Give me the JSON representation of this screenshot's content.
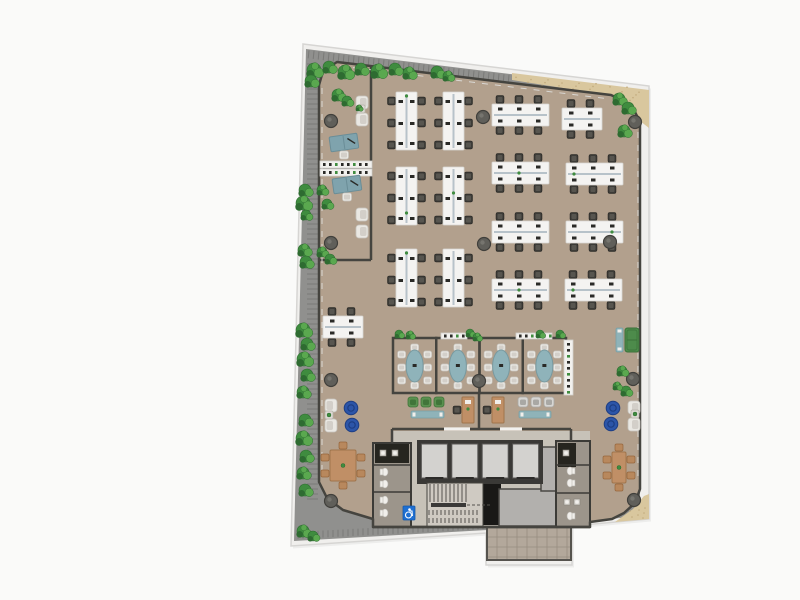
{
  "canvas": {
    "w": 800,
    "h": 600,
    "bg": "#fafaf9"
  },
  "palette": {
    "slab_fill": "#f0efed",
    "slab_stroke": "#d6d5d3",
    "shadow": "rgba(0,0,0,0.05)",
    "walkway": "#90908e",
    "walkway_line": "#7a7a78",
    "sand": "#d9c79e",
    "sand_dot": "#c2ab7d",
    "floor": "#b2a08d",
    "wall": "#45443f",
    "rail": "#d9d7d3",
    "desk_white": "#f4f3f1",
    "desk_stroke": "#d8d7d4",
    "spine": "#b7c2c9",
    "chair_dark": "#3c3b37",
    "chair_dark_hi": "#57554f",
    "item_dark": "#2a2a27",
    "teal_desk": "#7fa3ad",
    "teal_desk_dk": "#6a8d97",
    "meet_table": "#8fb3ba",
    "meet_table_dk": "#78999f",
    "chair_white": "#eae8e3",
    "chair_white_dk": "#c7c4be",
    "chair_white_in": "#d3cfc9",
    "green_dark": "#2e6b31",
    "green_mid": "#3f8c3f",
    "green_light": "#5aa84f",
    "pouf_blue": "#2c55a8",
    "pouf_blue_dk": "#1d3d82",
    "wood": "#c08f66",
    "wood_dk": "#a0754c",
    "wood_chair": "#b8885d",
    "sofa_green": "#4d8b4b",
    "sofa_green_dk": "#3a7139",
    "bench_teal": "#8fb3b9",
    "bench_teal_dk": "#79a0a7",
    "green_chair": "#5a9150",
    "green_chair_dk": "#41753a",
    "gray_chair": "#d7d6d3",
    "gray_chair_dk": "#a9a8a4",
    "column_fill": "#605f5a",
    "column_stroke": "#403f3b",
    "core_floor": "#c7c2b8",
    "elev_bank": "#3a3936",
    "elev_car": "#d3d2cf",
    "elev_car_stroke": "#595855",
    "dark_room": "#191816",
    "gray_room": "#b2b0ad",
    "wc_floor": "#9c958b",
    "wc_dark": "#26251f",
    "fixture": "#f1efeb",
    "stair_floor": "#cfcac2",
    "stair_line": "#55534d",
    "sign_blue": "#1e6fd2",
    "terrace": "#b3a89b",
    "terrace_line": "#978d80",
    "credenza": "#f2f1ee",
    "credenza_stroke": "#d2d1cd"
  },
  "plan": {
    "slab": [
      [
        303,
        44
      ],
      [
        649,
        86
      ],
      [
        649,
        519
      ],
      [
        572,
        526
      ],
      [
        572,
        565
      ],
      [
        486,
        565
      ],
      [
        486,
        533
      ],
      [
        291,
        546
      ]
    ],
    "walkway": [
      [
        306,
        49
      ],
      [
        640,
        90
      ],
      [
        640,
        516
      ],
      [
        571,
        523
      ],
      [
        571,
        561
      ],
      [
        487,
        561
      ],
      [
        487,
        530
      ],
      [
        294,
        541
      ]
    ],
    "sand_top": [
      [
        512,
        73
      ],
      [
        649,
        90
      ],
      [
        649,
        128
      ],
      [
        640,
        121
      ],
      [
        614,
        96
      ],
      [
        512,
        80
      ]
    ],
    "sand_br": [
      [
        649,
        494
      ],
      [
        649,
        519
      ],
      [
        615,
        522
      ],
      [
        633,
        509
      ],
      [
        644,
        496
      ]
    ],
    "floor": [
      [
        337,
        62
      ],
      [
        611,
        95
      ],
      [
        624,
        101
      ],
      [
        634,
        110
      ],
      [
        640,
        122
      ],
      [
        640,
        489
      ],
      [
        635,
        503
      ],
      [
        624,
        513
      ],
      [
        612,
        519
      ],
      [
        590,
        522
      ],
      [
        590,
        527
      ],
      [
        373,
        527
      ],
      [
        373,
        519
      ],
      [
        343,
        510
      ],
      [
        327,
        498
      ],
      [
        319,
        482
      ],
      [
        319,
        85
      ],
      [
        323,
        71
      ]
    ],
    "terrace": {
      "x": 487,
      "y": 527,
      "w": 84,
      "h": 33
    },
    "inner_walls": "M371,66 L371,260 M319,260 L371,260 M319,168 L371,168 M479,393 L479,429 M392,429 L571,429 M392,429 L392,443 M571,429 L571,441 M373,527 L590,527",
    "rails": [
      [
        340,
        66,
        610,
        99
      ],
      [
        322,
        88,
        322,
        474
      ],
      [
        638,
        132,
        638,
        482
      ]
    ],
    "door_gaps": [
      [
        444,
        429,
        26
      ],
      [
        500,
        429,
        22
      ]
    ],
    "core": {
      "floor": [
        392,
        431,
        198,
        96
      ],
      "wc_left": {
        "x": 373,
        "y": 443,
        "w": 38,
        "h": 84
      },
      "wc_right": {
        "x": 556,
        "y": 441,
        "w": 34,
        "h": 86
      },
      "elev": {
        "x": 417,
        "y": 440,
        "w": 126,
        "h": 44,
        "n": 4
      },
      "stairs": {
        "x": 427,
        "y": 483,
        "w": 56,
        "h": 44
      },
      "dark_room": [
        477,
        484,
        24,
        41
      ],
      "gray_rooms": [
        [
          499,
          489,
          61,
          37
        ],
        [
          541,
          447,
          19,
          44
        ]
      ],
      "sign": [
        403,
        506,
        12,
        14
      ]
    },
    "benches": [
      {
        "x": 396,
        "y": 92,
        "dir": "v",
        "seats": 6
      },
      {
        "x": 443,
        "y": 92,
        "dir": "v",
        "seats": 6
      },
      {
        "x": 396,
        "y": 167,
        "dir": "v",
        "seats": 6
      },
      {
        "x": 443,
        "y": 167,
        "dir": "v",
        "seats": 6
      },
      {
        "x": 396,
        "y": 249,
        "dir": "v",
        "seats": 6
      },
      {
        "x": 443,
        "y": 249,
        "dir": "v",
        "seats": 6
      },
      {
        "x": 492,
        "y": 104,
        "dir": "h",
        "seats": 6
      },
      {
        "x": 562,
        "y": 108,
        "dir": "h",
        "seats": 4
      },
      {
        "x": 492,
        "y": 162,
        "dir": "h",
        "seats": 6
      },
      {
        "x": 566,
        "y": 163,
        "dir": "h",
        "seats": 6
      },
      {
        "x": 492,
        "y": 221,
        "dir": "h",
        "seats": 6
      },
      {
        "x": 566,
        "y": 221,
        "dir": "h",
        "seats": 6
      },
      {
        "x": 492,
        "y": 279,
        "dir": "h",
        "seats": 6
      },
      {
        "x": 565,
        "y": 279,
        "dir": "h",
        "seats": 6
      },
      {
        "x": 323,
        "y": 316,
        "dir": "h",
        "seats": 4
      }
    ],
    "meeting": {
      "x": 393,
      "y": 338,
      "w": 173,
      "h": 55,
      "rooms": 4
    },
    "credenzas": [
      [
        320,
        161,
        52,
        7
      ],
      [
        320,
        169,
        52,
        7
      ],
      [
        441,
        333,
        26,
        6
      ],
      [
        516,
        333,
        36,
        6
      ],
      [
        564,
        340,
        9,
        55
      ]
    ],
    "exec_desks": [
      [
        330,
        135,
        -8
      ],
      [
        333,
        177,
        -8
      ]
    ],
    "armchairs": [
      [
        356,
        96,
        "L"
      ],
      [
        356,
        113,
        "L"
      ],
      [
        356,
        208,
        "L"
      ],
      [
        356,
        225,
        "L"
      ],
      [
        325,
        399,
        "R"
      ],
      [
        325,
        419,
        "R"
      ],
      [
        628,
        401,
        "L"
      ],
      [
        628,
        418,
        "L"
      ]
    ],
    "side_tables": [
      [
        357,
        105
      ],
      [
        325,
        411
      ],
      [
        631,
        410
      ]
    ],
    "poufs": [
      [
        351,
        408
      ],
      [
        352,
        425
      ],
      [
        613,
        408
      ],
      [
        611,
        424
      ]
    ],
    "dinings": [
      [
        330,
        450,
        26,
        31
      ],
      [
        612,
        452,
        14,
        31
      ]
    ],
    "hotdesks": [
      [
        462,
        397
      ],
      [
        492,
        397
      ]
    ],
    "trios": [
      {
        "x": 408,
        "y": 397,
        "c": "green"
      },
      {
        "x": 518,
        "y": 397,
        "c": "gray"
      }
    ],
    "teal_benches": [
      [
        411,
        411,
        33,
        7
      ],
      [
        519,
        411,
        32,
        7
      ],
      [
        616,
        328,
        7,
        24
      ]
    ],
    "sofa": [
      625,
      328,
      14,
      24
    ],
    "columns": [
      [
        331,
        121
      ],
      [
        331,
        243
      ],
      [
        331,
        380
      ],
      [
        331,
        501
      ],
      [
        483,
        117
      ],
      [
        484,
        244
      ],
      [
        479,
        381
      ],
      [
        610,
        242
      ],
      [
        635,
        122
      ],
      [
        633,
        379
      ],
      [
        634,
        500
      ]
    ],
    "plants": [
      [
        314,
        70,
        7
      ],
      [
        329,
        67,
        6
      ],
      [
        345,
        72,
        7
      ],
      [
        361,
        69,
        6
      ],
      [
        378,
        71,
        7
      ],
      [
        395,
        69,
        6
      ],
      [
        409,
        73,
        6
      ],
      [
        437,
        72,
        6
      ],
      [
        448,
        76,
        5
      ],
      [
        311,
        81,
        6
      ],
      [
        338,
        95,
        6
      ],
      [
        347,
        101,
        5
      ],
      [
        359,
        108,
        3
      ],
      [
        305,
        190,
        6
      ],
      [
        303,
        203,
        7
      ],
      [
        306,
        215,
        5
      ],
      [
        304,
        250,
        6
      ],
      [
        306,
        262,
        6
      ],
      [
        303,
        330,
        7
      ],
      [
        307,
        344,
        6
      ],
      [
        304,
        359,
        7
      ],
      [
        307,
        375,
        6
      ],
      [
        303,
        392,
        6
      ],
      [
        305,
        420,
        6
      ],
      [
        303,
        438,
        7
      ],
      [
        306,
        456,
        6
      ],
      [
        303,
        473,
        6
      ],
      [
        305,
        490,
        6
      ],
      [
        303,
        531,
        6
      ],
      [
        313,
        536,
        5
      ],
      [
        322,
        190,
        5
      ],
      [
        327,
        204,
        5
      ],
      [
        322,
        252,
        5
      ],
      [
        330,
        259,
        5
      ],
      [
        619,
        99,
        6
      ],
      [
        628,
        108,
        6
      ],
      [
        624,
        131,
        6
      ],
      [
        560,
        334,
        4
      ],
      [
        622,
        371,
        5
      ],
      [
        626,
        391,
        5
      ],
      [
        617,
        386,
        4
      ],
      [
        399,
        334,
        4
      ],
      [
        410,
        335,
        4
      ],
      [
        470,
        333,
        4
      ],
      [
        477,
        337,
        4
      ],
      [
        540,
        334,
        4
      ]
    ]
  }
}
